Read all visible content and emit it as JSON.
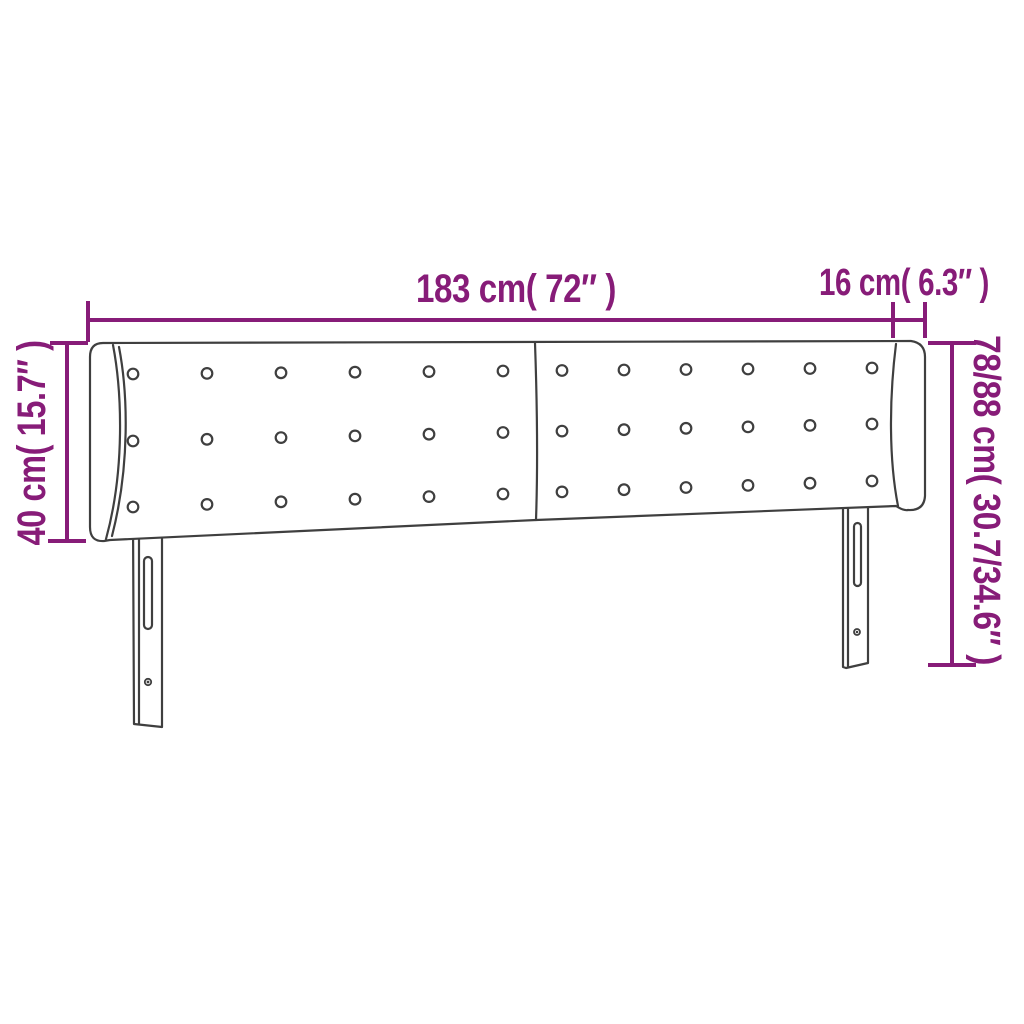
{
  "figure": {
    "background_color": "#ffffff",
    "dimension_color": "#871c78",
    "drawing_color": "#3f3f3f",
    "dimensions": {
      "total_width": {
        "label": "183 cm( 72″ )"
      },
      "ear_depth": {
        "label": "16 cm( 6.3″ )"
      },
      "panel_height": {
        "label": "40 cm( 15.7″ )"
      },
      "total_height": {
        "label": "78/88 cm( 30.7/34.6″ )"
      }
    },
    "buttons": {
      "cols": [
        133,
        207,
        281,
        355,
        429,
        503,
        562,
        624,
        686,
        748,
        810,
        872
      ],
      "x_first": 133,
      "x_last": 872,
      "rows": [
        {
          "y_first": 374,
          "y_last": 368
        },
        {
          "y_first": 441,
          "y_last": 424
        },
        {
          "y_first": 507,
          "y_last": 481
        }
      ],
      "radius": 5.3
    }
  }
}
